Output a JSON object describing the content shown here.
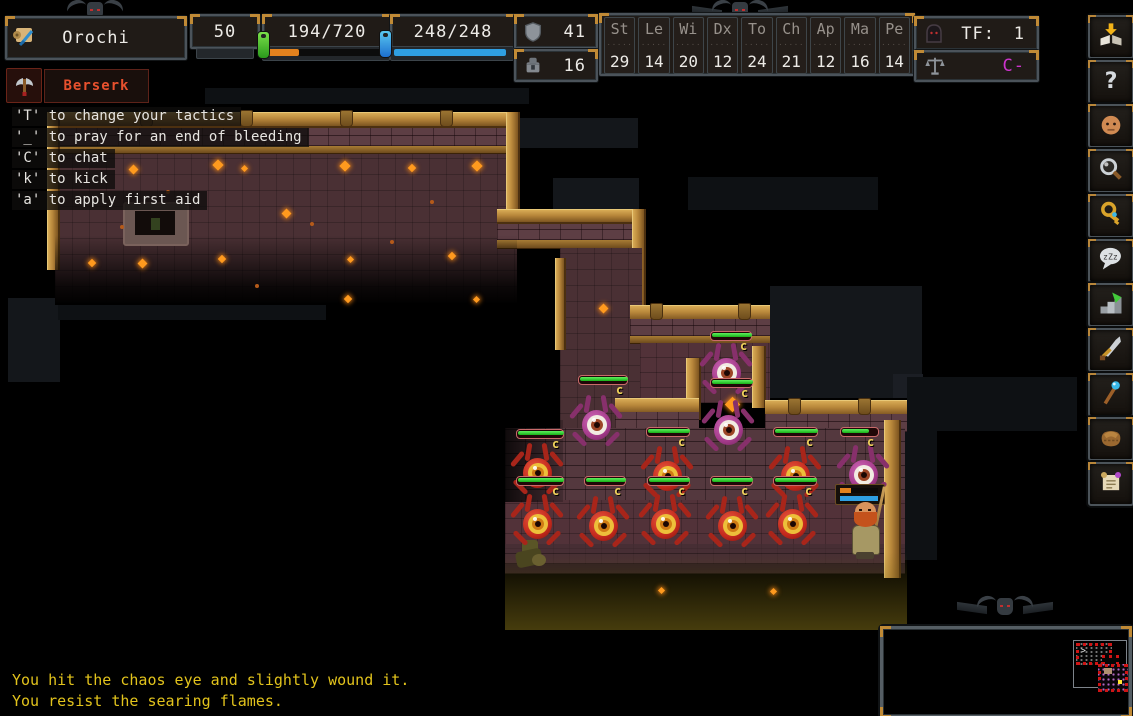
{
  "hud": {
    "character_name": "Orochi",
    "level": "50",
    "hp": "194/720",
    "hp_pct": 27,
    "pp": "248/248",
    "pp_pct": 100,
    "dv": "41",
    "pv": "16",
    "stats": [
      {
        "label": "St",
        "value": "29"
      },
      {
        "label": "Le",
        "value": "14"
      },
      {
        "label": "Wi",
        "value": "20"
      },
      {
        "label": "Dx",
        "value": "12"
      },
      {
        "label": "To",
        "value": "24"
      },
      {
        "label": "Ch",
        "value": "21"
      },
      {
        "label": "Ap",
        "value": "12"
      },
      {
        "label": "Ma",
        "value": "16"
      },
      {
        "label": "Pe",
        "value": "14"
      }
    ],
    "tf_label": "TF:",
    "tf_value": "1",
    "alignment": "C-",
    "tactic": "Berserk"
  },
  "hints": [
    "'T' to change your tactics",
    "'_' to pray for an end of bleeding",
    "'C' to chat",
    "'k' to kick",
    "'a' to apply first aid"
  ],
  "log": [
    "You hit the chaos eye and slightly wound it.",
    "You resist the searing flames."
  ],
  "sidebar_icons": [
    {
      "name": "message-log-icon"
    },
    {
      "name": "help-icon"
    },
    {
      "name": "character-icon"
    },
    {
      "name": "look-icon"
    },
    {
      "name": "keys-icon"
    },
    {
      "name": "chat-icon"
    },
    {
      "name": "descend-stairs-icon"
    },
    {
      "name": "weapon-icon"
    },
    {
      "name": "magic-icon"
    },
    {
      "name": "inventory-icon"
    },
    {
      "name": "scroll-icon"
    }
  ],
  "map": {
    "monster_label": "c",
    "monsters": [
      {
        "type": "purple",
        "x": 703,
        "y": 346
      },
      {
        "type": "purple",
        "x": 705,
        "y": 403
      },
      {
        "type": "purple",
        "x": 573,
        "y": 398
      },
      {
        "type": "tame",
        "x": 840,
        "y": 448
      },
      {
        "type": "red",
        "x": 514,
        "y": 446
      },
      {
        "type": "red",
        "x": 644,
        "y": 449
      },
      {
        "type": "red",
        "x": 772,
        "y": 449
      },
      {
        "type": "red",
        "x": 514,
        "y": 497
      },
      {
        "type": "red",
        "x": 580,
        "y": 499
      },
      {
        "type": "red",
        "x": 642,
        "y": 497
      },
      {
        "type": "red",
        "x": 709,
        "y": 499
      },
      {
        "type": "red",
        "x": 769,
        "y": 497
      }
    ],
    "health_bars": [
      {
        "x": 710,
        "y": 331,
        "w": 40,
        "pct": 100
      },
      {
        "x": 578,
        "y": 375,
        "w": 48,
        "pct": 100
      },
      {
        "x": 710,
        "y": 378,
        "w": 41,
        "pct": 100
      },
      {
        "x": 516,
        "y": 429,
        "w": 46,
        "pct": 100
      },
      {
        "x": 646,
        "y": 427,
        "w": 42,
        "pct": 100
      },
      {
        "x": 773,
        "y": 427,
        "w": 43,
        "pct": 100
      },
      {
        "x": 840,
        "y": 427,
        "w": 37,
        "pct": 72
      },
      {
        "x": 516,
        "y": 476,
        "w": 46,
        "pct": 100
      },
      {
        "x": 584,
        "y": 476,
        "w": 40,
        "pct": 100
      },
      {
        "x": 647,
        "y": 476,
        "w": 41,
        "pct": 100
      },
      {
        "x": 710,
        "y": 476,
        "w": 41,
        "pct": 100
      },
      {
        "x": 773,
        "y": 476,
        "w": 42,
        "pct": 100
      }
    ],
    "player": {
      "x": 842,
      "y": 498,
      "hp_pct": 30,
      "pp_pct": 100
    }
  },
  "colors": {
    "hp_bar": "#e2821e",
    "pp_bar": "#2f9fe2",
    "health_fill": "#2ed32e",
    "log_text": "#e2c31c",
    "tactic_text": "#e8512e",
    "alignment_text": "#cc33cc",
    "label_text": "#f2d35c"
  }
}
